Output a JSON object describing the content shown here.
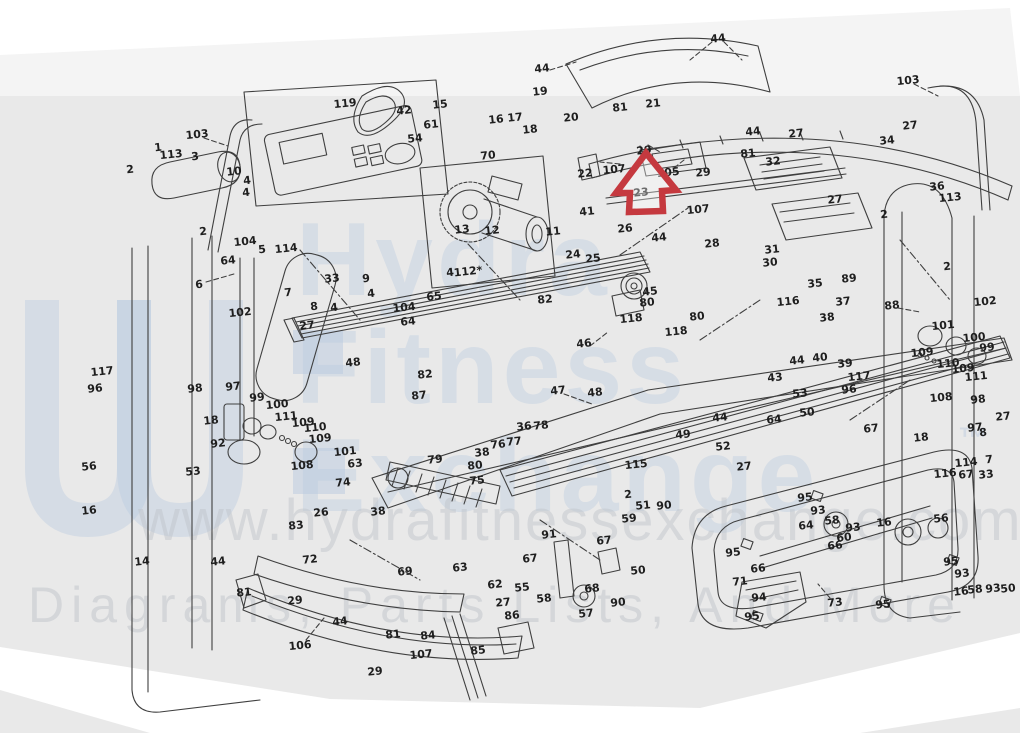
{
  "image": {
    "width": 1020,
    "height": 733,
    "description": "Scanned exploded-view parts diagram of a folding treadmill with numbered callouts; a red arrow annotation points up at part 29 on the upper side rail."
  },
  "colors": {
    "paper": "#e9e9e9",
    "line": "#3f3f3f",
    "arrow_red": "#c5393f",
    "watermark_blue": "#b9cadf",
    "watermark_gray": "#c0c5cb"
  },
  "watermark": {
    "brand_lines": [
      "Hydra",
      "Fitness",
      "Exchange"
    ],
    "trademark": "™",
    "url_line": "www.hydrafitnessexchange.com",
    "tagline": "Diagrams, Parts Lists, And More"
  },
  "annotation": {
    "marker": "red-arrow-up",
    "target_part_number": "29",
    "tip_x": 646,
    "tip_y": 153
  },
  "part_labels": [
    {
      "t": "103",
      "x": 197,
      "y": 134
    },
    {
      "t": "1",
      "x": 158,
      "y": 147
    },
    {
      "t": "113",
      "x": 171,
      "y": 154
    },
    {
      "t": "3",
      "x": 195,
      "y": 156
    },
    {
      "t": "2",
      "x": 130,
      "y": 169
    },
    {
      "t": "10",
      "x": 234,
      "y": 171
    },
    {
      "t": "4",
      "x": 247,
      "y": 180
    },
    {
      "t": "4",
      "x": 246,
      "y": 192
    },
    {
      "t": "2",
      "x": 203,
      "y": 231
    },
    {
      "t": "104",
      "x": 245,
      "y": 241
    },
    {
      "t": "119",
      "x": 345,
      "y": 103
    },
    {
      "t": "42",
      "x": 404,
      "y": 110
    },
    {
      "t": "61",
      "x": 431,
      "y": 124
    },
    {
      "t": "54",
      "x": 415,
      "y": 138
    },
    {
      "t": "15",
      "x": 440,
      "y": 104
    },
    {
      "t": "44",
      "x": 542,
      "y": 68
    },
    {
      "t": "19",
      "x": 540,
      "y": 91
    },
    {
      "t": "16",
      "x": 496,
      "y": 119
    },
    {
      "t": "17",
      "x": 515,
      "y": 117
    },
    {
      "t": "18",
      "x": 530,
      "y": 129
    },
    {
      "t": "20",
      "x": 571,
      "y": 117
    },
    {
      "t": "70",
      "x": 488,
      "y": 155
    },
    {
      "t": "22",
      "x": 585,
      "y": 173
    },
    {
      "t": "23",
      "x": 641,
      "y": 192
    },
    {
      "t": "41",
      "x": 587,
      "y": 211
    },
    {
      "t": "13",
      "x": 462,
      "y": 229
    },
    {
      "t": "12",
      "x": 492,
      "y": 230
    },
    {
      "t": "11",
      "x": 553,
      "y": 231
    },
    {
      "t": "24",
      "x": 573,
      "y": 254
    },
    {
      "t": "25",
      "x": 593,
      "y": 258
    },
    {
      "t": "26",
      "x": 625,
      "y": 228
    },
    {
      "t": "44",
      "x": 659,
      "y": 237
    },
    {
      "t": "28",
      "x": 712,
      "y": 243
    },
    {
      "t": "81",
      "x": 620,
      "y": 107
    },
    {
      "t": "21",
      "x": 653,
      "y": 103
    },
    {
      "t": "29",
      "x": 644,
      "y": 150
    },
    {
      "t": "107",
      "x": 614,
      "y": 169
    },
    {
      "t": "105",
      "x": 668,
      "y": 172
    },
    {
      "t": "29",
      "x": 703,
      "y": 172
    },
    {
      "t": "107",
      "x": 698,
      "y": 209
    },
    {
      "t": "44",
      "x": 718,
      "y": 38
    },
    {
      "t": "44",
      "x": 753,
      "y": 131
    },
    {
      "t": "27",
      "x": 796,
      "y": 133
    },
    {
      "t": "81",
      "x": 748,
      "y": 153
    },
    {
      "t": "32",
      "x": 773,
      "y": 161
    },
    {
      "t": "27",
      "x": 835,
      "y": 199
    },
    {
      "t": "34",
      "x": 887,
      "y": 140
    },
    {
      "t": "27",
      "x": 910,
      "y": 125
    },
    {
      "t": "103",
      "x": 908,
      "y": 80
    },
    {
      "t": "36",
      "x": 937,
      "y": 186
    },
    {
      "t": "113",
      "x": 950,
      "y": 197
    },
    {
      "t": "2",
      "x": 884,
      "y": 214
    },
    {
      "t": "31",
      "x": 772,
      "y": 249
    },
    {
      "t": "30",
      "x": 770,
      "y": 262
    },
    {
      "t": "35",
      "x": 815,
      "y": 283
    },
    {
      "t": "89",
      "x": 849,
      "y": 278
    },
    {
      "t": "116",
      "x": 788,
      "y": 301
    },
    {
      "t": "37",
      "x": 843,
      "y": 301
    },
    {
      "t": "38",
      "x": 827,
      "y": 317
    },
    {
      "t": "88",
      "x": 892,
      "y": 305
    },
    {
      "t": "102",
      "x": 985,
      "y": 301
    },
    {
      "t": "2",
      "x": 947,
      "y": 266
    },
    {
      "t": "45",
      "x": 650,
      "y": 291
    },
    {
      "t": "80",
      "x": 647,
      "y": 302
    },
    {
      "t": "118",
      "x": 631,
      "y": 318
    },
    {
      "t": "80",
      "x": 697,
      "y": 316
    },
    {
      "t": "118",
      "x": 676,
      "y": 331
    },
    {
      "t": "46",
      "x": 584,
      "y": 343
    },
    {
      "t": "9",
      "x": 366,
      "y": 278
    },
    {
      "t": "4",
      "x": 371,
      "y": 293
    },
    {
      "t": "4",
      "x": 450,
      "y": 272
    },
    {
      "t": "104",
      "x": 404,
      "y": 307
    },
    {
      "t": "64",
      "x": 408,
      "y": 321
    },
    {
      "t": "65",
      "x": 434,
      "y": 296
    },
    {
      "t": "112*",
      "x": 468,
      "y": 271
    },
    {
      "t": "82",
      "x": 545,
      "y": 299
    },
    {
      "t": "48",
      "x": 353,
      "y": 362
    },
    {
      "t": "82",
      "x": 425,
      "y": 374
    },
    {
      "t": "87",
      "x": 419,
      "y": 395
    },
    {
      "t": "47",
      "x": 558,
      "y": 390
    },
    {
      "t": "48",
      "x": 595,
      "y": 392
    },
    {
      "t": "36",
      "x": 524,
      "y": 426
    },
    {
      "t": "78",
      "x": 541,
      "y": 425
    },
    {
      "t": "76",
      "x": 498,
      "y": 444
    },
    {
      "t": "77",
      "x": 514,
      "y": 441
    },
    {
      "t": "38",
      "x": 482,
      "y": 452
    },
    {
      "t": "80",
      "x": 475,
      "y": 465
    },
    {
      "t": "75",
      "x": 477,
      "y": 480
    },
    {
      "t": "79",
      "x": 435,
      "y": 459
    },
    {
      "t": "5",
      "x": 262,
      "y": 249
    },
    {
      "t": "114",
      "x": 286,
      "y": 248
    },
    {
      "t": "64",
      "x": 228,
      "y": 260
    },
    {
      "t": "33",
      "x": 332,
      "y": 278
    },
    {
      "t": "7",
      "x": 288,
      "y": 292
    },
    {
      "t": "8",
      "x": 314,
      "y": 306
    },
    {
      "t": "4",
      "x": 334,
      "y": 307
    },
    {
      "t": "27",
      "x": 307,
      "y": 325
    },
    {
      "t": "6",
      "x": 199,
      "y": 284
    },
    {
      "t": "102",
      "x": 240,
      "y": 312
    },
    {
      "t": "117",
      "x": 102,
      "y": 371
    },
    {
      "t": "96",
      "x": 95,
      "y": 388
    },
    {
      "t": "98",
      "x": 195,
      "y": 388
    },
    {
      "t": "97",
      "x": 233,
      "y": 386
    },
    {
      "t": "99",
      "x": 257,
      "y": 397
    },
    {
      "t": "100",
      "x": 277,
      "y": 404
    },
    {
      "t": "111",
      "x": 286,
      "y": 416
    },
    {
      "t": "109",
      "x": 303,
      "y": 422
    },
    {
      "t": "110",
      "x": 315,
      "y": 427
    },
    {
      "t": "109",
      "x": 320,
      "y": 438
    },
    {
      "t": "108",
      "x": 302,
      "y": 465
    },
    {
      "t": "18",
      "x": 211,
      "y": 420
    },
    {
      "t": "92",
      "x": 218,
      "y": 443
    },
    {
      "t": "56",
      "x": 89,
      "y": 466
    },
    {
      "t": "53",
      "x": 193,
      "y": 471
    },
    {
      "t": "16",
      "x": 89,
      "y": 510
    },
    {
      "t": "101",
      "x": 345,
      "y": 451
    },
    {
      "t": "63",
      "x": 355,
      "y": 463
    },
    {
      "t": "74",
      "x": 343,
      "y": 482
    },
    {
      "t": "38",
      "x": 378,
      "y": 511
    },
    {
      "t": "26",
      "x": 321,
      "y": 512
    },
    {
      "t": "83",
      "x": 296,
      "y": 525
    },
    {
      "t": "14",
      "x": 142,
      "y": 561
    },
    {
      "t": "44",
      "x": 218,
      "y": 561
    },
    {
      "t": "72",
      "x": 310,
      "y": 559
    },
    {
      "t": "81",
      "x": 244,
      "y": 592
    },
    {
      "t": "29",
      "x": 295,
      "y": 600
    },
    {
      "t": "106",
      "x": 300,
      "y": 645
    },
    {
      "t": "44",
      "x": 340,
      "y": 621
    },
    {
      "t": "81",
      "x": 393,
      "y": 634
    },
    {
      "t": "29",
      "x": 375,
      "y": 671
    },
    {
      "t": "107",
      "x": 421,
      "y": 654
    },
    {
      "t": "84",
      "x": 428,
      "y": 635
    },
    {
      "t": "85",
      "x": 478,
      "y": 650
    },
    {
      "t": "69",
      "x": 405,
      "y": 571
    },
    {
      "t": "63",
      "x": 460,
      "y": 567
    },
    {
      "t": "62",
      "x": 495,
      "y": 584
    },
    {
      "t": "55",
      "x": 522,
      "y": 587
    },
    {
      "t": "27",
      "x": 503,
      "y": 602
    },
    {
      "t": "86",
      "x": 512,
      "y": 615
    },
    {
      "t": "58",
      "x": 544,
      "y": 598
    },
    {
      "t": "68",
      "x": 592,
      "y": 588
    },
    {
      "t": "57",
      "x": 586,
      "y": 613
    },
    {
      "t": "90",
      "x": 618,
      "y": 602
    },
    {
      "t": "50",
      "x": 638,
      "y": 570
    },
    {
      "t": "59",
      "x": 629,
      "y": 518
    },
    {
      "t": "51",
      "x": 643,
      "y": 505
    },
    {
      "t": "90",
      "x": 664,
      "y": 505
    },
    {
      "t": "67",
      "x": 604,
      "y": 540
    },
    {
      "t": "67",
      "x": 530,
      "y": 558
    },
    {
      "t": "91",
      "x": 549,
      "y": 534
    },
    {
      "t": "115",
      "x": 636,
      "y": 464
    },
    {
      "t": "2",
      "x": 628,
      "y": 494
    },
    {
      "t": "43",
      "x": 775,
      "y": 377
    },
    {
      "t": "53",
      "x": 800,
      "y": 393
    },
    {
      "t": "40",
      "x": 820,
      "y": 357
    },
    {
      "t": "39",
      "x": 845,
      "y": 363
    },
    {
      "t": "44",
      "x": 797,
      "y": 360
    },
    {
      "t": "117",
      "x": 859,
      "y": 376
    },
    {
      "t": "96",
      "x": 849,
      "y": 389
    },
    {
      "t": "67",
      "x": 871,
      "y": 428
    },
    {
      "t": "18",
      "x": 921,
      "y": 437
    },
    {
      "t": "97",
      "x": 975,
      "y": 427
    },
    {
      "t": "98",
      "x": 978,
      "y": 399
    },
    {
      "t": "27",
      "x": 1003,
      "y": 416
    },
    {
      "t": "8",
      "x": 983,
      "y": 432
    },
    {
      "t": "7",
      "x": 989,
      "y": 459
    },
    {
      "t": "114",
      "x": 966,
      "y": 462
    },
    {
      "t": "33",
      "x": 986,
      "y": 474
    },
    {
      "t": "67",
      "x": 966,
      "y": 474
    },
    {
      "t": "116",
      "x": 945,
      "y": 473
    },
    {
      "t": "109",
      "x": 922,
      "y": 352
    },
    {
      "t": "110",
      "x": 948,
      "y": 363
    },
    {
      "t": "109",
      "x": 963,
      "y": 368
    },
    {
      "t": "111",
      "x": 976,
      "y": 376
    },
    {
      "t": "108",
      "x": 941,
      "y": 397
    },
    {
      "t": "101",
      "x": 943,
      "y": 325
    },
    {
      "t": "100",
      "x": 974,
      "y": 337
    },
    {
      "t": "99",
      "x": 987,
      "y": 347
    },
    {
      "t": "64",
      "x": 774,
      "y": 419
    },
    {
      "t": "50",
      "x": 807,
      "y": 412
    },
    {
      "t": "52",
      "x": 723,
      "y": 446
    },
    {
      "t": "27",
      "x": 744,
      "y": 466
    },
    {
      "t": "44",
      "x": 720,
      "y": 417
    },
    {
      "t": "49",
      "x": 683,
      "y": 434
    },
    {
      "t": "95",
      "x": 805,
      "y": 497
    },
    {
      "t": "93",
      "x": 818,
      "y": 510
    },
    {
      "t": "58",
      "x": 832,
      "y": 520
    },
    {
      "t": "93",
      "x": 853,
      "y": 527
    },
    {
      "t": "64",
      "x": 806,
      "y": 525
    },
    {
      "t": "16",
      "x": 884,
      "y": 522
    },
    {
      "t": "56",
      "x": 941,
      "y": 518
    },
    {
      "t": "60",
      "x": 844,
      "y": 537
    },
    {
      "t": "66",
      "x": 835,
      "y": 545
    },
    {
      "t": "95",
      "x": 733,
      "y": 552
    },
    {
      "t": "66",
      "x": 758,
      "y": 568
    },
    {
      "t": "71",
      "x": 740,
      "y": 581
    },
    {
      "t": "94",
      "x": 759,
      "y": 597
    },
    {
      "t": "95",
      "x": 752,
      "y": 616
    },
    {
      "t": "73",
      "x": 835,
      "y": 602
    },
    {
      "t": "95",
      "x": 883,
      "y": 604
    },
    {
      "t": "95",
      "x": 951,
      "y": 561
    },
    {
      "t": "93",
      "x": 962,
      "y": 573
    },
    {
      "t": "16",
      "x": 961,
      "y": 591
    },
    {
      "t": "58",
      "x": 975,
      "y": 589
    },
    {
      "t": "93",
      "x": 993,
      "y": 588
    },
    {
      "t": "50",
      "x": 1008,
      "y": 588
    }
  ]
}
